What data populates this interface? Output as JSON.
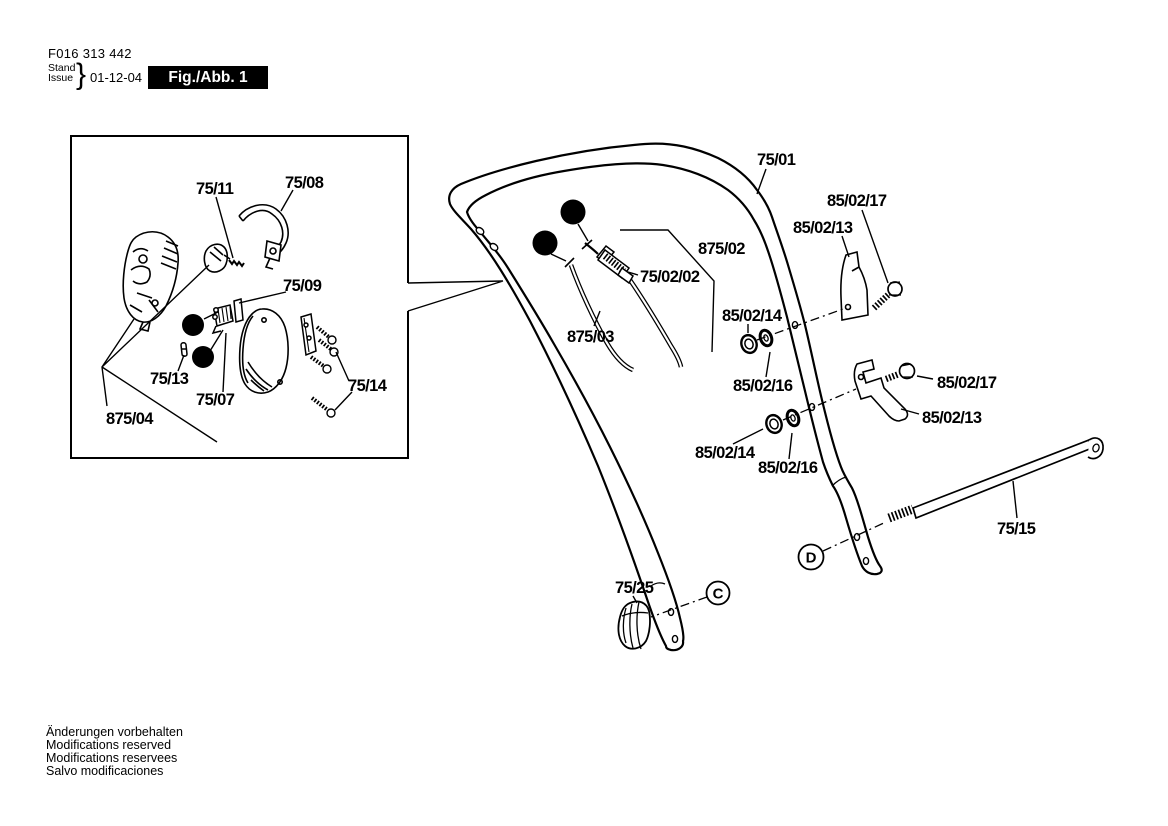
{
  "header": {
    "part_number": "F016 313 442",
    "stand": "Stand",
    "issue": "Issue",
    "brace": "}",
    "date": "01-12-04",
    "figure_label": "Fig./Abb. 1"
  },
  "figure": {
    "inset": {
      "labels": {
        "l75_11": "75/11",
        "l75_08": "75/08",
        "l75_09": "75/09",
        "l75_13": "75/13",
        "l75_07": "75/07",
        "l875_04": "875/04",
        "l75_14": "75/14"
      },
      "badges": {
        "a": "A",
        "b": "B"
      }
    },
    "main": {
      "labels": {
        "l75_01": "75/01",
        "l85_02_17_top": "85/02/17",
        "l85_02_13_top": "85/02/13",
        "l875_02": "875/02",
        "l75_02_02": "75/02/02",
        "l875_03": "875/03",
        "l85_02_14_upper": "85/02/14",
        "l85_02_16_upper": "85/02/16",
        "l85_02_14_lower": "85/02/14",
        "l85_02_16_lower": "85/02/16",
        "l85_02_17_right": "85/02/17",
        "l85_02_13_right": "85/02/13",
        "l75_15": "75/15",
        "l75_25": "75/25"
      },
      "badges": {
        "a": "A",
        "b": "B",
        "c": "C",
        "d": "D"
      }
    }
  },
  "footer": {
    "lines": [
      "Änderungen vorbehalten",
      "Modifications reserved",
      "Modifications reservees",
      "Salvo modificaciones"
    ]
  },
  "colors": {
    "ink": "#000000",
    "paper": "#ffffff"
  }
}
